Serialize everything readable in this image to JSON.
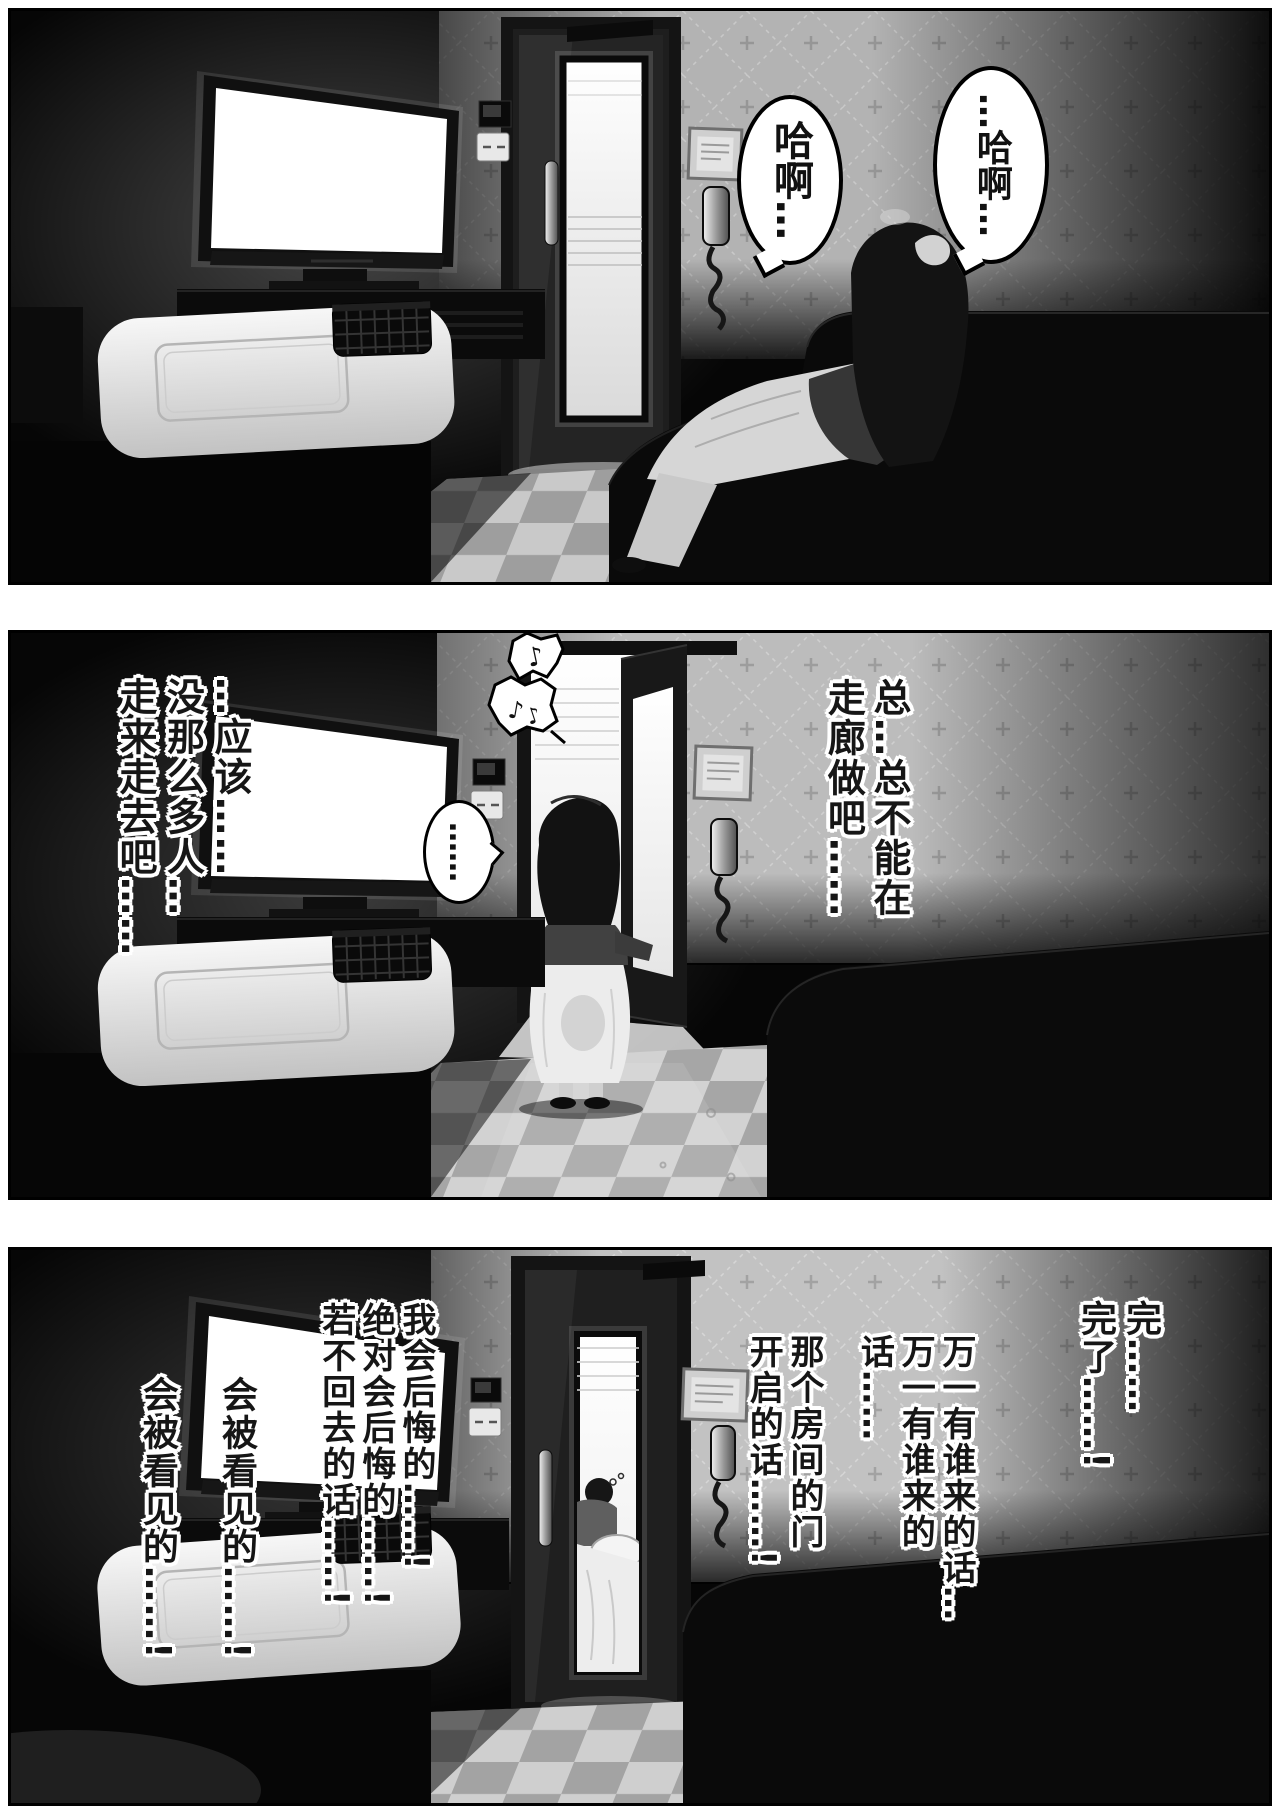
{
  "colors": {
    "ink": "#000000",
    "paper": "#ffffff",
    "wallpaper": "#b8b8b8",
    "corridor_light": "#f7f7f7"
  },
  "panel1": {
    "bubble_left": "哈啊…",
    "bubble_right": "…哈啊…"
  },
  "panel2": {
    "monologue_left": "…应该……\n没那么多人…\n走来走去吧……",
    "monologue_right": "总…总不能在\n走廊做吧……",
    "ellipsis_bubble": "……",
    "notes": {
      "n1": "♪",
      "n2": "♪",
      "n3": "♪"
    }
  },
  "panel3": {
    "monologue_done": "完……\n完了……!",
    "monologue_if_someone_comes": "万一有谁来的话…\n万一有谁来的话……",
    "monologue_door_opens": "那个房间的门\n开启的话……!",
    "monologue_regret": "我会后悔的……!\n绝对会后悔的……!\n若不回去的话……!",
    "monologue_seen": "会被看见的……!\n会被看见的……!"
  }
}
